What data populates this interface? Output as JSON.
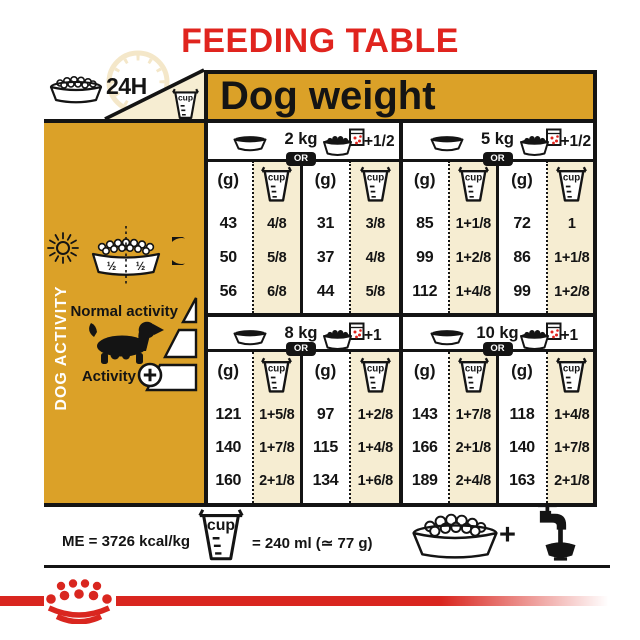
{
  "title": "FEEDING TABLE",
  "labels": {
    "hours": "24H",
    "cup": "cup"
  },
  "header": {
    "dog_weight": "Dog weight"
  },
  "sidebar": {
    "vertical_label": "DOG ACTIVITY",
    "bowl_left": "½",
    "bowl_right": "½",
    "normal_activity": "Normal activity",
    "activity": "Activity",
    "plus_icon": "+"
  },
  "table": {
    "sections": [
      {
        "blocks": [
          {
            "weight": "2 kg",
            "or": "OR",
            "extra": "+1/2",
            "col_headers": [
              "(g)",
              "cup",
              "(g)",
              "cup"
            ],
            "rows": [
              [
                "43",
                "4/8",
                "31",
                "3/8"
              ],
              [
                "50",
                "5/8",
                "37",
                "4/8"
              ],
              [
                "56",
                "6/8",
                "44",
                "5/8"
              ]
            ]
          },
          {
            "weight": "5 kg",
            "or": "OR",
            "extra": "+1/2",
            "col_headers": [
              "(g)",
              "cup",
              "(g)",
              "cup"
            ],
            "rows": [
              [
                "85",
                "1+1/8",
                "72",
                "1"
              ],
              [
                "99",
                "1+2/8",
                "86",
                "1+1/8"
              ],
              [
                "112",
                "1+4/8",
                "99",
                "1+2/8"
              ]
            ]
          }
        ]
      },
      {
        "blocks": [
          {
            "weight": "8 kg",
            "or": "OR",
            "extra": "+1",
            "col_headers": [
              "(g)",
              "cup",
              "(g)",
              "cup"
            ],
            "rows": [
              [
                "121",
                "1+5/8",
                "97",
                "1+2/8"
              ],
              [
                "140",
                "1+7/8",
                "115",
                "1+4/8"
              ],
              [
                "160",
                "2+1/8",
                "134",
                "1+6/8"
              ]
            ]
          },
          {
            "weight": "10 kg",
            "or": "OR",
            "extra": "+1",
            "col_headers": [
              "(g)",
              "cup",
              "(g)",
              "cup"
            ],
            "rows": [
              [
                "143",
                "1+7/8",
                "118",
                "1+4/8"
              ],
              [
                "166",
                "2+1/8",
                "140",
                "1+7/8"
              ],
              [
                "189",
                "2+4/8",
                "163",
                "2+1/8"
              ]
            ]
          }
        ]
      }
    ]
  },
  "bottom": {
    "me": "ME = 3726 kcal/kg",
    "equiv": "= 240 ml (≃ 77 g)",
    "plus": "+"
  },
  "colors": {
    "gold": "#DBA128",
    "cream": "#F6EDD2",
    "red": "#E0241E",
    "black": "#141414"
  }
}
